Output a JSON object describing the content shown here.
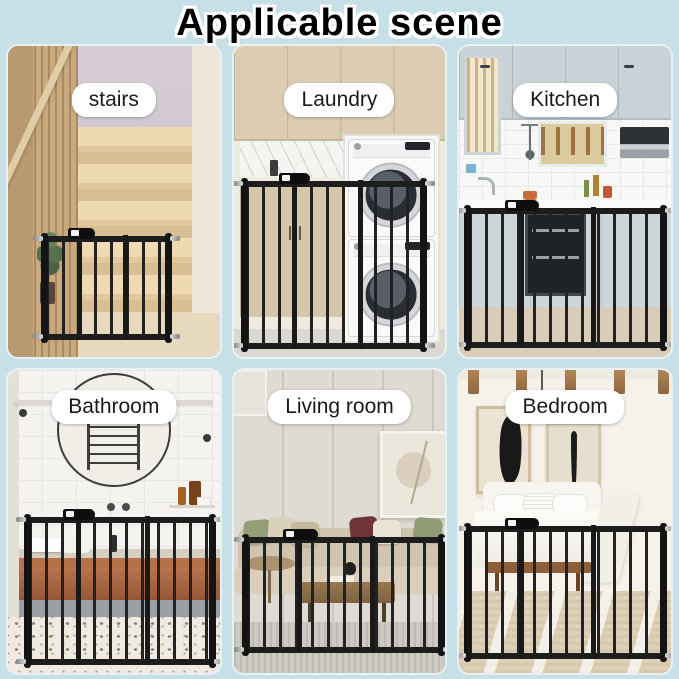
{
  "title": "Applicable scene",
  "panels": [
    {
      "id": "stairs",
      "label": "stairs"
    },
    {
      "id": "laundry",
      "label": "Laundry"
    },
    {
      "id": "kitchen",
      "label": "Kitchen"
    },
    {
      "id": "bathroom",
      "label": "Bathroom"
    },
    {
      "id": "living-room",
      "label": "Living room"
    },
    {
      "id": "bedroom",
      "label": "Bedroom"
    }
  ],
  "colors": {
    "page_background": "#c7dfe6",
    "title_text": "#000000",
    "title_outline": "#ffffff",
    "label_background": "#ffffff",
    "label_text": "#1a1a1a",
    "gate_metal": "#1d1d1d"
  }
}
